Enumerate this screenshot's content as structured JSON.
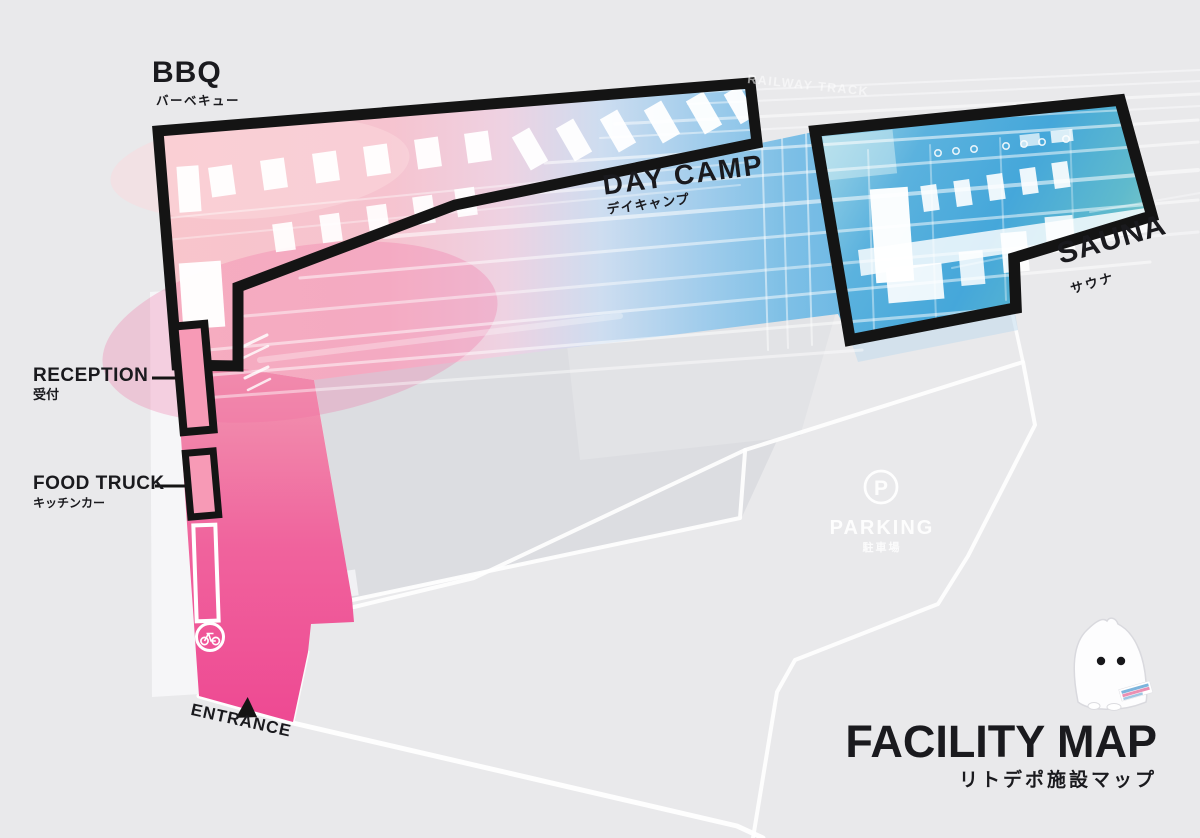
{
  "map": {
    "railway_label": "RAILWAY TRACK",
    "areas": {
      "bbq": {
        "name": "BBQ",
        "name_jp": "バーベキュー"
      },
      "day_camp": {
        "name": "DAY CAMP",
        "name_jp": "デイキャンプ"
      },
      "sauna": {
        "name": "SAUNA",
        "name_jp": "サウナ"
      },
      "reception": {
        "name": "RECEPTION",
        "name_jp": "受付"
      },
      "food_truck": {
        "name": "FOOD TRUCK",
        "name_jp": "キッチンカー"
      },
      "parking": {
        "name": "PARKING",
        "name_jp": "駐車場",
        "icon_letter": "P"
      },
      "entrance": {
        "name": "ENTRANCE"
      }
    },
    "title": {
      "main": "FACILITY MAP",
      "sub": "リトデポ施設マップ"
    },
    "colors": {
      "pink": "#ee4892",
      "light_pink": "#f8c5cb",
      "sky_blue": "#49a8d8",
      "teal": "#8ccec2",
      "outline": "#141414",
      "background": "#e9e9eb",
      "road": "#ffffff"
    }
  }
}
